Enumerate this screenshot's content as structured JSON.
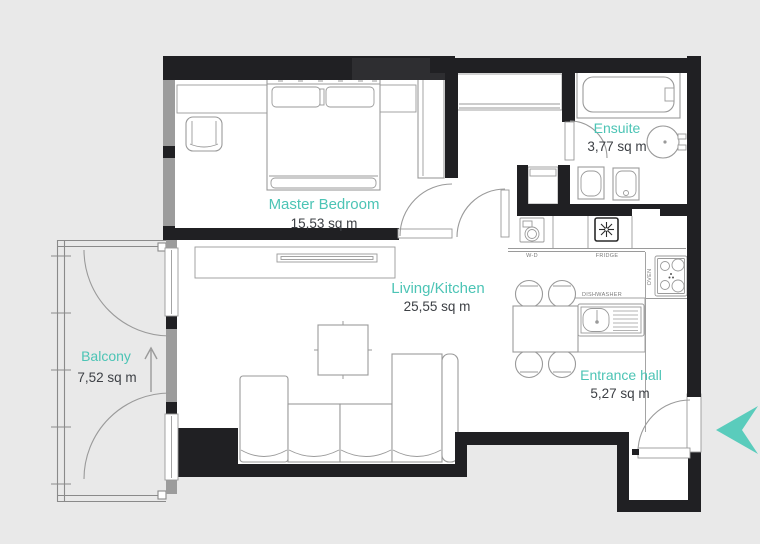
{
  "plan": {
    "title": "Apartment floor plan",
    "rooms": [
      {
        "id": "master_bedroom",
        "name": "Master Bedroom",
        "area": "15,53 sq m"
      },
      {
        "id": "ensuite",
        "name": "Ensuite",
        "area": "3,77 sq m"
      },
      {
        "id": "living_kitchen",
        "name": "Living/Kitchen",
        "area": "25,55 sq m"
      },
      {
        "id": "balcony",
        "name": "Balcony",
        "area": "7,52 sq m"
      },
      {
        "id": "entrance_hall",
        "name": "Entrance hall",
        "area": "5,27 sq m"
      }
    ],
    "appliances": {
      "washer_dryer": "W-D",
      "fridge": "FRIDGE",
      "oven": "OVEN",
      "dishwasher": "DISHWASHER"
    },
    "icons": {
      "entry_arrow": "entry-direction-arrow",
      "balcony_arrow": "balcony-direction-arrow",
      "fridge_icon": "snowflake",
      "washer_icon": "washing-machine-drum"
    },
    "colors": {
      "room_label": "#4cc4b5",
      "area_label": "#3d4045",
      "wall": "#202023",
      "window_wall": "#9c9c9c",
      "floor": "#ffffff",
      "background": "#e9e9e9",
      "entry_arrow": "#5accbc",
      "furniture_line": "#9a9a9a"
    }
  }
}
